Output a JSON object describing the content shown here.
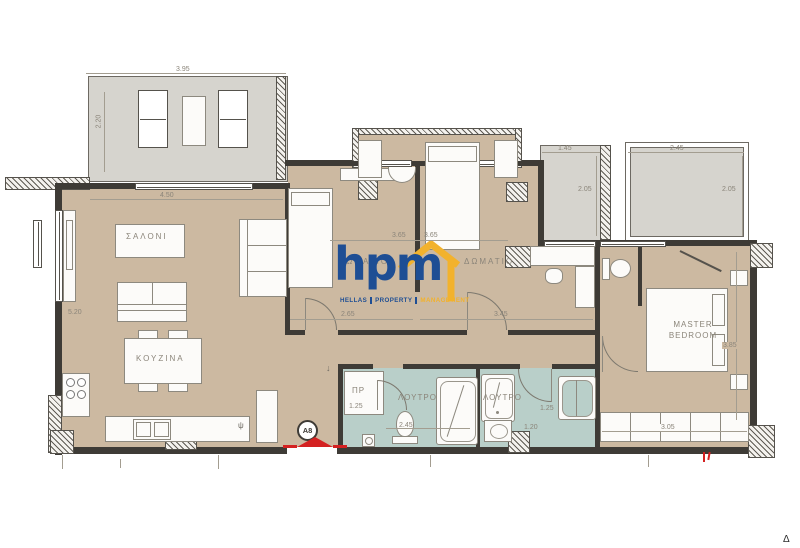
{
  "plan": {
    "unit": "A8",
    "sheet_mark": "Δ",
    "entrance_arrow": "↓",
    "fridge_mark": "ψ"
  },
  "logo": {
    "text": "hpm",
    "words": [
      "HELLAS",
      "PROPERTY",
      "MANAGEMENT"
    ]
  },
  "labels": {
    "living": "ΣΑΛΟΝΙ",
    "kitchen": "ΚΟΥΖΙΝΑ",
    "bedroom1": "ΔΩΜΑΤΙΟ",
    "bedroom2": "ΔΩΜΑΤΙΟ",
    "master_line1": "MASTER",
    "master_line2": "BEDROOM",
    "bath1": "ΛΟΥΤΡΟ",
    "bath2": "ΛΟΥΤΡΟ",
    "closet": "ΠΡ"
  },
  "dims": {
    "terrace_w": "3.95",
    "terrace_h": "2.20",
    "living_w": "4.50",
    "living_h": "5.20",
    "nook_left": "3.65",
    "nook_right": "3.65",
    "bedroom1_w": "2.65",
    "bedroom2_w": "3.45",
    "balcony1_w": "1.45",
    "balcony1_d": "2.05",
    "balcony2_w": "2.45",
    "balcony2_d": "2.05",
    "closet_w": "1.25",
    "bath1_w": "2.45",
    "bath2_w": "1.25",
    "bath2_b": "1.20",
    "master_w": "3.05",
    "master_h": "3.85"
  },
  "colors": {
    "floor": "#ccb9a1",
    "balcony": "#d6d4ce",
    "bathroom": "#b9cfc9",
    "wall": "#3e3b36",
    "logo_blue": "#1e4e94",
    "logo_yellow": "#f2b22d",
    "accent_red": "#d42121"
  }
}
